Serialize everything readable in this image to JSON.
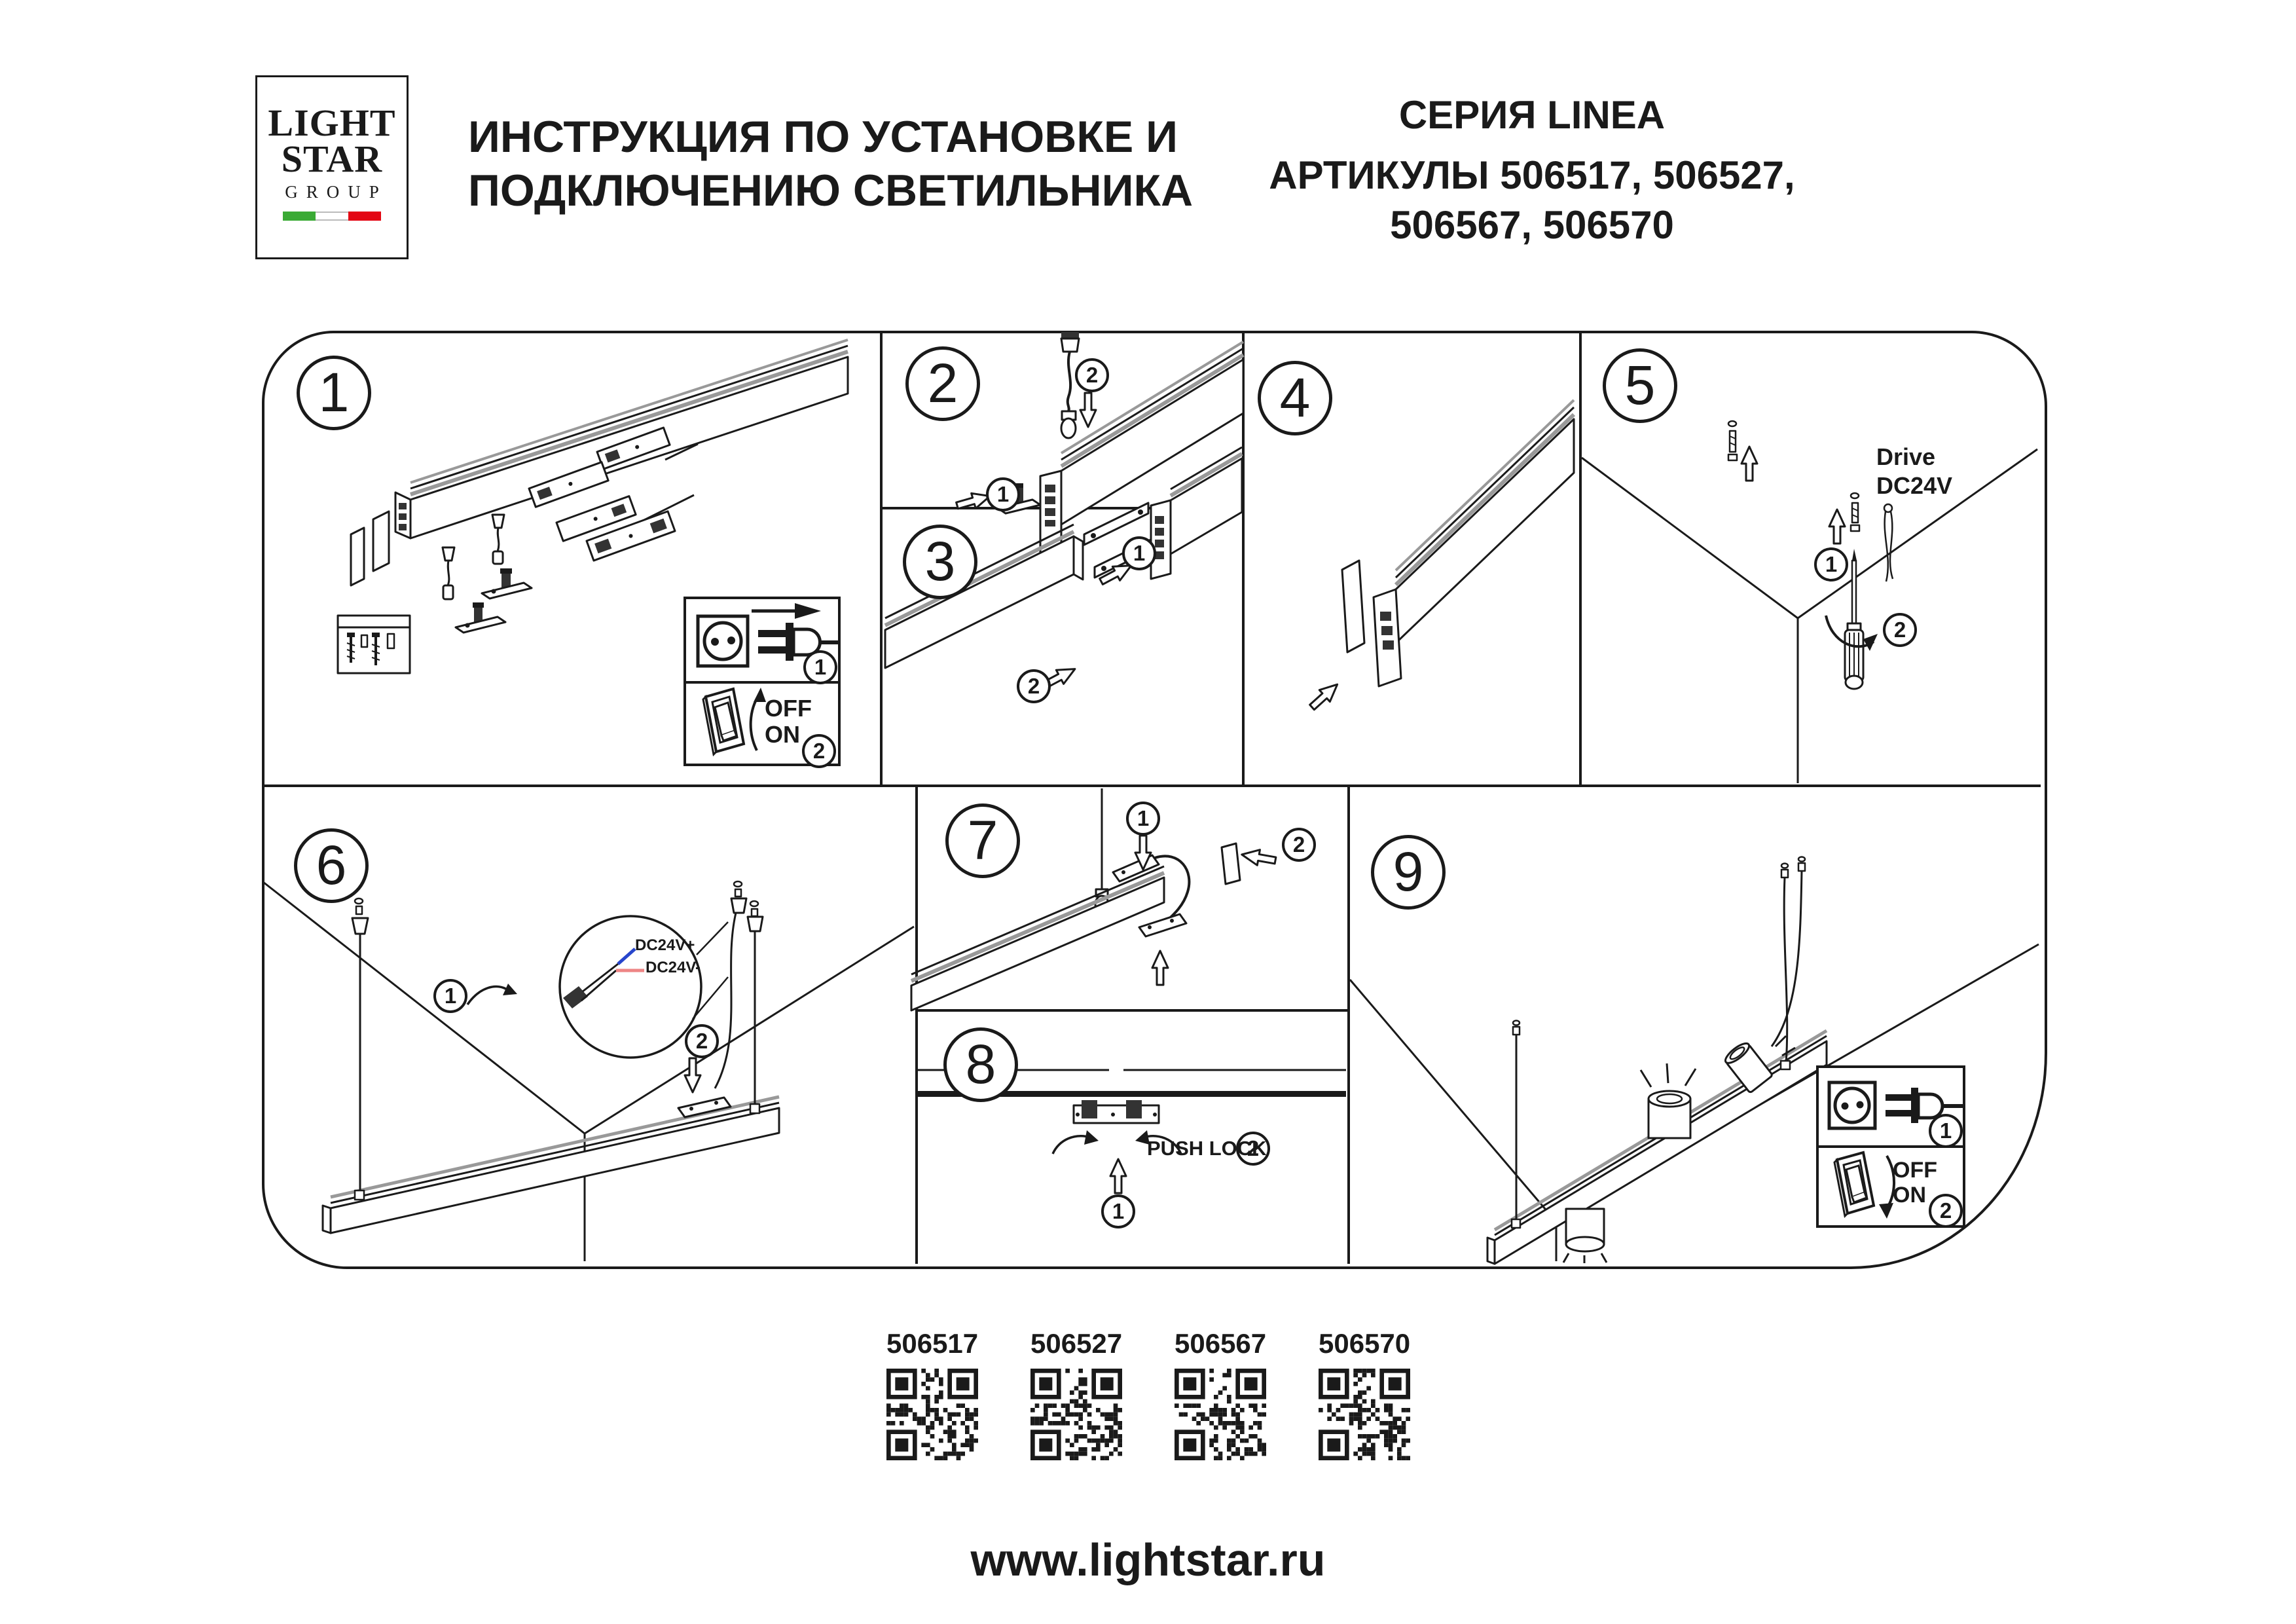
{
  "header": {
    "logo": {
      "line1": "LIGHT",
      "line2": "STAR",
      "line3": "GROUP"
    },
    "title": {
      "line1": "ИНСТРУКЦИЯ ПО УСТАНОВКЕ И",
      "line2": "ПОДКЛЮЧЕНИЮ СВЕТИЛЬНИКА"
    },
    "series": "СЕРИЯ LINEA",
    "articles": {
      "line1": "АРТИКУЛЫ 506517, 506527,",
      "line2": "506567, 506570"
    }
  },
  "panels": [
    {
      "number": "1"
    },
    {
      "number": "2"
    },
    {
      "number": "3"
    },
    {
      "number": "4"
    },
    {
      "number": "5"
    },
    {
      "number": "6"
    },
    {
      "number": "7"
    },
    {
      "number": "8"
    },
    {
      "number": "9"
    }
  ],
  "steps": {
    "one": "1",
    "two": "2"
  },
  "labels": {
    "off": "OFF",
    "on": "ON",
    "push_lock": "PUSH LOCK",
    "drive_line1": "Drive",
    "drive_line2": "DC24V",
    "dc24v_plus": "DC24V+",
    "dc24v_minus": "DC24V-"
  },
  "qr": {
    "items": [
      {
        "article": "506517"
      },
      {
        "article": "506527"
      },
      {
        "article": "506567"
      },
      {
        "article": "506570"
      }
    ]
  },
  "footer": {
    "url": "www.lightstar.ru"
  },
  "colors": {
    "ink": "#1a1a1a",
    "wire_positive": "#2745cc",
    "wire_negative": "#ee8585",
    "flag_green": "#3aaa35",
    "flag_red": "#e30613"
  }
}
